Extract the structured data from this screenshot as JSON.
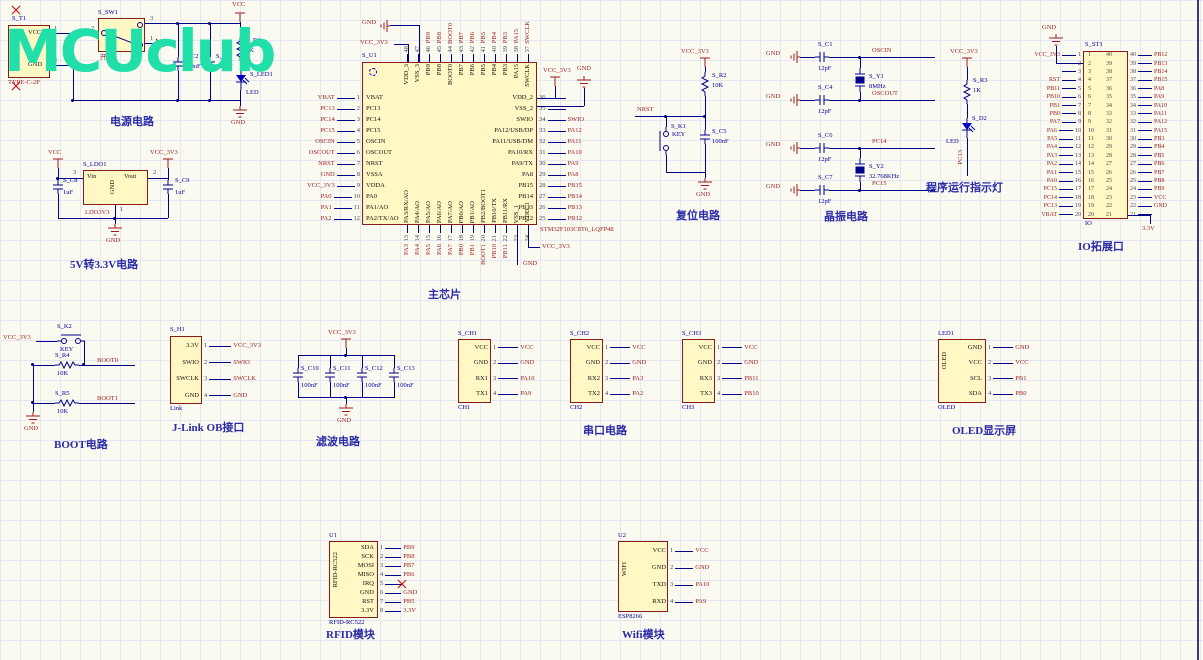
{
  "logo": {
    "text": "MCUclub"
  },
  "colors": {
    "logo": "#20DFA8",
    "wire": "#00008B",
    "net": "#9B1B1B",
    "body": "#FFF8C5",
    "border": "#8B1A1A"
  },
  "power": {
    "caption": "电源电路",
    "vcc": "VCC",
    "gnd": "GND",
    "t1": {
      "designator": "S_T1",
      "part": "TYPE-C-2P",
      "pin1_name": "VCC",
      "pin1_num": "1",
      "pin2_name": "GND",
      "pin2_num": "2"
    },
    "sw": {
      "designator": "S_SW1",
      "label": "开关",
      "pin_left": "2",
      "pin_tr": "3",
      "pin_br": "1"
    },
    "c2": {
      "designator": "S_C2",
      "value": "100uF"
    },
    "c3": {
      "designator": "S_C3",
      "value": "100nF"
    },
    "r1": {
      "designator": "S_R1",
      "value": "1K"
    },
    "led": {
      "designator": "S_LED1",
      "value": "LED"
    }
  },
  "ldo": {
    "caption": "5V转3.3V电路",
    "designator": "S_LDO1",
    "part": "LDO3V3",
    "vcc": "VCC",
    "vcc33": "VCC_3V3",
    "gnd": "GND",
    "vin": "Vin",
    "vout": "Vout",
    "gnd_pin": "GND",
    "n_vin": "3",
    "n_vout": "2",
    "n_gnd": "1",
    "c8": {
      "designator": "S_C8",
      "value": "1uF"
    },
    "c9": {
      "designator": "S_C9",
      "value": "1uF"
    }
  },
  "mcu": {
    "caption": "主芯片",
    "designator": "S_U1",
    "part": "STM32F103C8T6_LQFP48",
    "top_gnd": "GND",
    "top_vcc": "VCC_3V3",
    "bot_gnd": "GND",
    "bot_vcc": "VCC_3V3",
    "right_vcc": "VCC_3V3",
    "right_gnd": "GND",
    "left": [
      {
        "num": "1",
        "name": "VBAT",
        "net": "VBAT"
      },
      {
        "num": "2",
        "name": "PC13",
        "net": "PC13"
      },
      {
        "num": "3",
        "name": "PC14",
        "net": "PC14"
      },
      {
        "num": "4",
        "name": "PC15",
        "net": "PC15"
      },
      {
        "num": "5",
        "name": "OSCIN",
        "net": "OSCIN"
      },
      {
        "num": "6",
        "name": "OSCOUT",
        "net": "OSCOUT"
      },
      {
        "num": "7",
        "name": "NRST",
        "net": "NRST"
      },
      {
        "num": "8",
        "name": "VSSA",
        "net": "GND"
      },
      {
        "num": "9",
        "name": "VDDA",
        "net": "VCC_3V3"
      },
      {
        "num": "10",
        "name": "PA0",
        "net": "PA0"
      },
      {
        "num": "11",
        "name": "PA1/AO",
        "net": "PA1"
      },
      {
        "num": "12",
        "name": "PA2/TX/AO",
        "net": "PA2"
      }
    ],
    "right": [
      {
        "num": "36",
        "name": "VDD_2",
        "net": ""
      },
      {
        "num": "35",
        "name": "VSS_2",
        "net": ""
      },
      {
        "num": "34",
        "name": "SWIO",
        "net": "SWIO"
      },
      {
        "num": "33",
        "name": "PA12/USB/DP",
        "net": "PA12"
      },
      {
        "num": "32",
        "name": "PA11/USB/DM",
        "net": "PA11"
      },
      {
        "num": "31",
        "name": "PA10/RX",
        "net": "PA10"
      },
      {
        "num": "30",
        "name": "PA9/TX",
        "net": "PA9"
      },
      {
        "num": "29",
        "name": "PA8",
        "net": "PA8"
      },
      {
        "num": "28",
        "name": "PB15",
        "net": "PB15"
      },
      {
        "num": "27",
        "name": "PB14",
        "net": "PB14"
      },
      {
        "num": "26",
        "name": "PB13",
        "net": "PB13"
      },
      {
        "num": "25",
        "name": "PB12",
        "net": "PB12"
      }
    ],
    "top": [
      {
        "num": "48",
        "name": "VDD_3",
        "net": ""
      },
      {
        "num": "47",
        "name": "VSS_3",
        "net": ""
      },
      {
        "num": "46",
        "name": "PB9",
        "net": "PB9"
      },
      {
        "num": "45",
        "name": "PB8",
        "net": "PB8"
      },
      {
        "num": "44",
        "name": "BOOT0",
        "net": "BOOT0"
      },
      {
        "num": "43",
        "name": "PB7",
        "net": "PB7"
      },
      {
        "num": "42",
        "name": "PB6",
        "net": "PB6"
      },
      {
        "num": "41",
        "name": "PB5",
        "net": "PB5"
      },
      {
        "num": "40",
        "name": "PB4",
        "net": "PB4"
      },
      {
        "num": "39",
        "name": "PB3",
        "net": "PB3"
      },
      {
        "num": "38",
        "name": "PA15",
        "net": "PA15"
      },
      {
        "num": "37",
        "name": "SWCLK",
        "net": "SWCLK"
      }
    ],
    "bottom": [
      {
        "num": "13",
        "name": "PA3/RX/AO",
        "net": "PA3"
      },
      {
        "num": "14",
        "name": "PA4/AO",
        "net": "PA4"
      },
      {
        "num": "15",
        "name": "PA5/AO",
        "net": "PA5"
      },
      {
        "num": "16",
        "name": "PA6/AO",
        "net": "PA6"
      },
      {
        "num": "17",
        "name": "PA7/AO",
        "net": "PA7"
      },
      {
        "num": "18",
        "name": "PB0/AO",
        "net": "PB0"
      },
      {
        "num": "19",
        "name": "PB1/AO",
        "net": "PB1"
      },
      {
        "num": "20",
        "name": "PB2/BOOT1",
        "net": "BOOT1"
      },
      {
        "num": "21",
        "name": "PB10/TX",
        "net": "PB10"
      },
      {
        "num": "22",
        "name": "PB11/RX",
        "net": "PB11"
      },
      {
        "num": "23",
        "name": "VSS_1",
        "net": ""
      },
      {
        "num": "24",
        "name": "VDD_1",
        "net": ""
      }
    ]
  },
  "reset": {
    "caption": "复位电路",
    "nrst": "NRST",
    "vcc": "VCC_3V3",
    "gnd": "GND",
    "r2": {
      "designator": "S_R2",
      "value": "10K"
    },
    "k1": {
      "designator": "S_K1",
      "value": "KEY"
    },
    "c5": {
      "designator": "S_C5",
      "value": "100nF"
    }
  },
  "crystal": {
    "caption": "晶振电路",
    "gnd": "GND",
    "g1": {
      "c_top": {
        "designator": "S_C1",
        "value": "12pF"
      },
      "net_top": "OSCIN",
      "xtal": {
        "designator": "S_Y1",
        "value": "8MHz"
      },
      "c_bot": {
        "designator": "S_C4",
        "value": "12pF"
      },
      "net_bot": "OSCOUT"
    },
    "g2": {
      "c_top": {
        "designator": "S_C6",
        "value": "12pF"
      },
      "net_top": "PC14",
      "xtal": {
        "designator": "S_Y2",
        "value": "32.768KHz"
      },
      "c_bot": {
        "designator": "S_C7",
        "value": "12pF"
      },
      "net_bot": "PC15"
    }
  },
  "run_led": {
    "caption": "程序运行指示灯",
    "vcc": "VCC_3V3",
    "net": "PC13",
    "r3": {
      "designator": "S_R3",
      "value": "1K"
    },
    "d2": {
      "designator": "S_D2",
      "value": "LED"
    }
  },
  "io": {
    "caption": "IO拓展口",
    "designator": "S_ST1",
    "part": "IO",
    "gnd_top": "GND",
    "v33": "3.3V",
    "left": [
      {
        "num": "1",
        "net": "VCC_3V3"
      },
      {
        "num": "2",
        "net": ""
      },
      {
        "num": "3",
        "net": ""
      },
      {
        "num": "4",
        "net": "RST"
      },
      {
        "num": "5",
        "net": "PB11"
      },
      {
        "num": "6",
        "net": "PB10"
      },
      {
        "num": "7",
        "net": "PB1"
      },
      {
        "num": "8",
        "net": "PB0"
      },
      {
        "num": "9",
        "net": "PA7"
      },
      {
        "num": "10",
        "net": "PA6"
      },
      {
        "num": "11",
        "net": "PA5"
      },
      {
        "num": "12",
        "net": "PA4"
      },
      {
        "num": "13",
        "net": "PA3"
      },
      {
        "num": "14",
        "net": "PA2"
      },
      {
        "num": "15",
        "net": "PA1"
      },
      {
        "num": "16",
        "net": "PA0"
      },
      {
        "num": "17",
        "net": "PC15"
      },
      {
        "num": "18",
        "net": "PC14"
      },
      {
        "num": "19",
        "net": "PC13"
      },
      {
        "num": "20",
        "net": "VBAT"
      }
    ],
    "right": [
      {
        "num": "40",
        "net": "PB12"
      },
      {
        "num": "39",
        "net": "PB13"
      },
      {
        "num": "38",
        "net": "PB14"
      },
      {
        "num": "37",
        "net": "PB15"
      },
      {
        "num": "36",
        "net": "PA8"
      },
      {
        "num": "35",
        "net": "PA9"
      },
      {
        "num": "34",
        "net": "PA10"
      },
      {
        "num": "33",
        "net": "PA11"
      },
      {
        "num": "32",
        "net": "PA12"
      },
      {
        "num": "31",
        "net": "PA15"
      },
      {
        "num": "30",
        "net": "PB3"
      },
      {
        "num": "29",
        "net": "PB4"
      },
      {
        "num": "28",
        "net": "PB5"
      },
      {
        "num": "27",
        "net": "PB6"
      },
      {
        "num": "26",
        "net": "PB7"
      },
      {
        "num": "25",
        "net": "PB8"
      },
      {
        "num": "24",
        "net": "PB9"
      },
      {
        "num": "23",
        "net": "VCC"
      },
      {
        "num": "22",
        "net": "GND"
      },
      {
        "num": "21",
        "net": ""
      }
    ]
  },
  "boot": {
    "caption": "BOOT电路",
    "vcc": "VCC_3V3",
    "gnd": "GND",
    "boot0": "BOOT0",
    "boot1": "BOOT1",
    "k2": {
      "designator": "S_K2",
      "value": "KEY"
    },
    "r4": {
      "designator": "S_R4",
      "value": "10K"
    },
    "r5": {
      "designator": "S_R5",
      "value": "10K"
    }
  },
  "jlink": {
    "caption": "J-Link OB接口",
    "designator": "S_H1",
    "part": "Link",
    "rows": [
      {
        "name": "3.3V",
        "num": "1",
        "net": "VCC_3V3"
      },
      {
        "name": "SWIO",
        "num": "2",
        "net": "SWIO"
      },
      {
        "name": "SWCLK",
        "num": "3",
        "net": "SWCLK"
      },
      {
        "name": "GND",
        "num": "4",
        "net": "GND"
      }
    ]
  },
  "filter": {
    "caption": "滤波电路",
    "vcc": "VCC_3V3",
    "gnd": "GND",
    "caps": [
      {
        "designator": "S_C10",
        "value": "100nF"
      },
      {
        "designator": "S_C11",
        "value": "100nF"
      },
      {
        "designator": "S_C12",
        "value": "100nF"
      },
      {
        "designator": "S_C13",
        "value": "100nF"
      }
    ]
  },
  "serial": {
    "caption": "串口电路",
    "channels": [
      {
        "designator": "S_CH1",
        "part": "CH1",
        "rows": [
          {
            "name": "VCC",
            "num": "1",
            "net": "VCC"
          },
          {
            "name": "GND",
            "num": "2",
            "net": "GND"
          },
          {
            "name": "RX1",
            "num": "3",
            "net": "PA10"
          },
          {
            "name": "TX1",
            "num": "4",
            "net": "PA9"
          }
        ]
      },
      {
        "designator": "S_CH2",
        "part": "CH2",
        "rows": [
          {
            "name": "VCC",
            "num": "1",
            "net": "VCC"
          },
          {
            "name": "GND",
            "num": "2",
            "net": "GND"
          },
          {
            "name": "RX2",
            "num": "3",
            "net": "PA3"
          },
          {
            "name": "TX2",
            "num": "4",
            "net": "PA2"
          }
        ]
      },
      {
        "designator": "S_CH3",
        "part": "CH3",
        "rows": [
          {
            "name": "VCC",
            "num": "1",
            "net": "VCC"
          },
          {
            "name": "GND",
            "num": "2",
            "net": "GND"
          },
          {
            "name": "RX3",
            "num": "3",
            "net": "PB11"
          },
          {
            "name": "TX3",
            "num": "4",
            "net": "PB10"
          }
        ]
      }
    ]
  },
  "oled": {
    "caption": "OLED显示屏",
    "designator": "LED1",
    "part": "OLED",
    "side_label": "OLED",
    "rows": [
      {
        "name": "GND",
        "num": "1",
        "net": "GND"
      },
      {
        "name": "VCC",
        "num": "2",
        "net": "VCC"
      },
      {
        "name": "SCL",
        "num": "3",
        "net": "PB1"
      },
      {
        "name": "SDA",
        "num": "4",
        "net": "PB0"
      }
    ]
  },
  "rfid": {
    "caption": "RFID模块",
    "designator": "U1",
    "part": "RFID-RC522",
    "side_label": "RFID-RC522",
    "rows": [
      {
        "name": "SDA",
        "num": "1",
        "net": "PB9"
      },
      {
        "name": "SCK",
        "num": "2",
        "net": "PB8"
      },
      {
        "name": "MOSI",
        "num": "3",
        "net": "PB7"
      },
      {
        "name": "MISO",
        "num": "4",
        "net": "PB6"
      },
      {
        "name": "IRQ",
        "num": "5",
        "net": ""
      },
      {
        "name": "GND",
        "num": "6",
        "net": "GND"
      },
      {
        "name": "RST",
        "num": "7",
        "net": "PB5"
      },
      {
        "name": "3.3V",
        "num": "8",
        "net": "3.3V"
      }
    ]
  },
  "wifi": {
    "caption": "Wifi模块",
    "designator": "U2",
    "part": "ESP8266",
    "side_label": "WIFI",
    "rows": [
      {
        "name": "VCC",
        "num": "1",
        "net": "VCC"
      },
      {
        "name": "GND",
        "num": "2",
        "net": "GND"
      },
      {
        "name": "TXD",
        "num": "3",
        "net": "PA10"
      },
      {
        "name": "RXD",
        "num": "4",
        "net": "PA9"
      }
    ]
  }
}
